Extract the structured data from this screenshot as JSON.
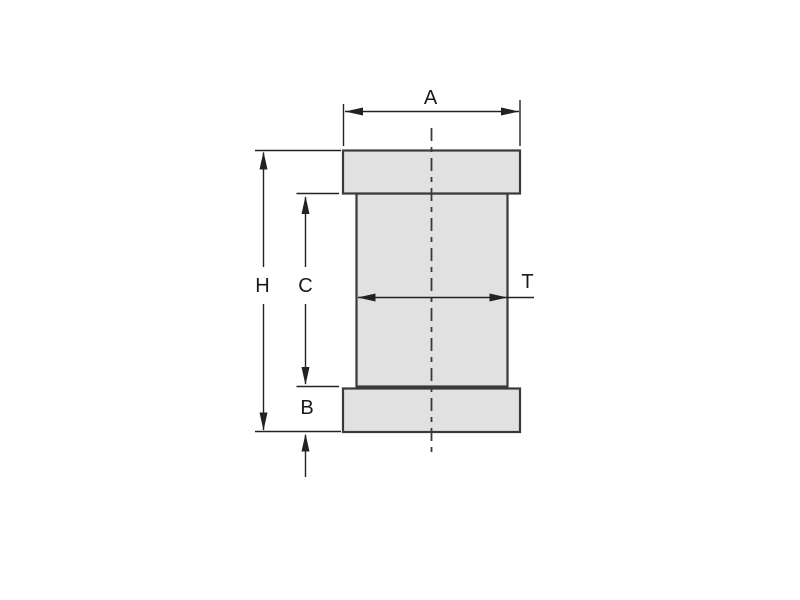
{
  "colors": {
    "background": "#ffffff",
    "part_fill": "#e1e1e1",
    "part_stroke": "#3a3a3a",
    "dim_line": "#222222",
    "text": "#1a1a1a"
  },
  "drawing": {
    "kind": "technical-dimension-diagram",
    "dimensions": {
      "a": {
        "label": "A"
      },
      "h": {
        "label": "H"
      },
      "c": {
        "label": "C"
      },
      "b": {
        "label": "B"
      },
      "t": {
        "label": "T"
      }
    }
  }
}
